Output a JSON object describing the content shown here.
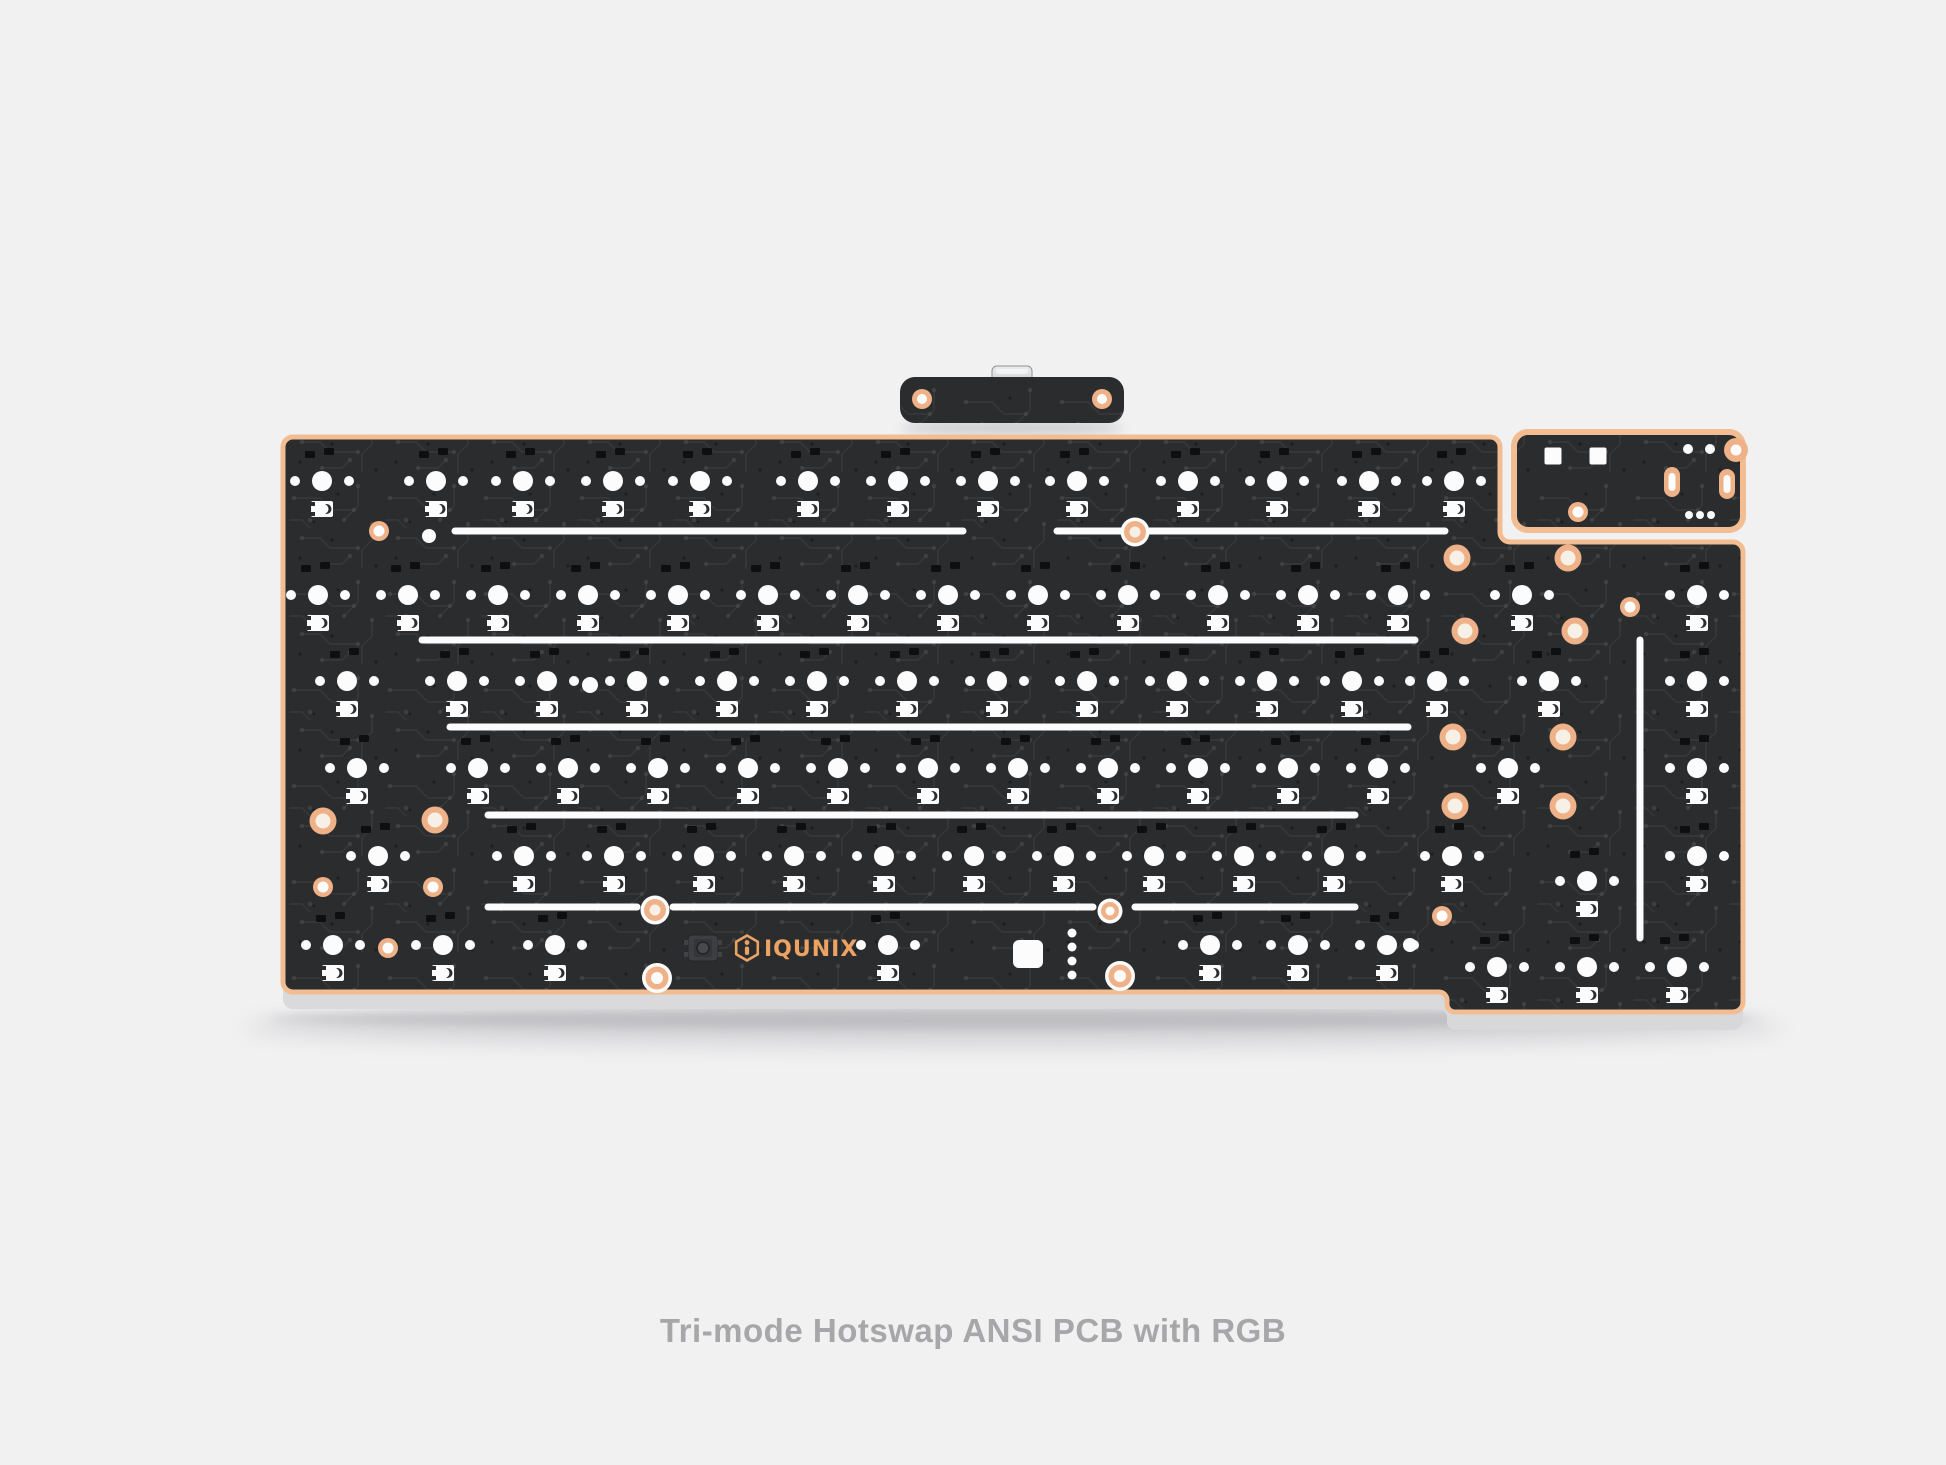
{
  "caption": {
    "text": "Tri-mode Hotswap ANSI PCB with RGB"
  },
  "logo": {
    "brand": "IQUNIX"
  },
  "palette": {
    "background": "#f1f1f2",
    "board": "#2b2c2d",
    "trace": "#45474a",
    "trace_dot": "#505255",
    "trace_dark": "#1b1c1d",
    "copper": "#f2bd92",
    "ring_copper": "#efb187",
    "cream": "#f7f0e6",
    "white": "#fcfcfd",
    "pad_dark": "#0e0f10",
    "logo_copper": "#eba263",
    "caption_gray": "#a7a7a9",
    "metal_light": "#eceded",
    "metal_dark": "#a7a9ac",
    "side_top": "#ffffff",
    "side_bottom": "#d8d8da",
    "shadow": "#73737a"
  },
  "board": {
    "left": 283,
    "top": 437,
    "right": 1743,
    "bottom_left": 992,
    "bottom_right": 1012,
    "notch_x": 1500,
    "notch_y": 542,
    "step_x": 1447,
    "corner_radius": 10
  },
  "usb_daughterboard": {
    "x": 900,
    "y": 377,
    "w": 224,
    "h": 46,
    "radius": 15,
    "screws": [
      [
        922,
        399
      ],
      [
        1102,
        399
      ]
    ],
    "connector": {
      "x": 992,
      "y": 366,
      "w": 40,
      "h": 38
    }
  },
  "corner_module": {
    "x": 1514,
    "y": 432,
    "w": 229,
    "h": 98,
    "radius": 14,
    "squares": [
      [
        1553,
        456
      ],
      [
        1598,
        456
      ]
    ],
    "square_size": 17,
    "ring": [
      1578,
      512
    ],
    "corner_circle": [
      1736,
      450
    ],
    "top_dots": [
      [
        1688,
        449
      ],
      [
        1710,
        449
      ]
    ],
    "ovals": [
      [
        1672,
        482
      ],
      [
        1727,
        484
      ]
    ],
    "bottom_dots": [
      [
        1689,
        515
      ],
      [
        1700,
        515
      ],
      [
        1711,
        515
      ]
    ]
  },
  "switch_rows": [
    {
      "y": 481,
      "xs": [
        322,
        436,
        523,
        613,
        700,
        808,
        898,
        988,
        1077,
        1188,
        1277,
        1369,
        1454
      ]
    },
    {
      "y": 595,
      "xs": [
        318,
        408,
        498,
        588,
        678,
        768,
        858,
        948,
        1038,
        1128,
        1218,
        1308,
        1398,
        1522,
        1697
      ]
    },
    {
      "y": 681,
      "xs": [
        347,
        457,
        547,
        637,
        727,
        817,
        907,
        997,
        1087,
        1177,
        1267,
        1352,
        1437,
        1549,
        1697
      ]
    },
    {
      "y": 768,
      "xs": [
        357,
        478,
        568,
        658,
        748,
        838,
        928,
        1018,
        1108,
        1198,
        1288,
        1378,
        1508,
        1697
      ]
    },
    {
      "y": 856,
      "xs": [
        378,
        524,
        614,
        704,
        794,
        884,
        974,
        1064,
        1154,
        1244,
        1334,
        1452,
        1697
      ]
    },
    {
      "y": 945,
      "xs": [
        333,
        443,
        555,
        888,
        1210,
        1298,
        1387
      ]
    }
  ],
  "extra_clusters": [
    [
      1587,
      881
    ],
    [
      1497,
      967
    ],
    [
      1587,
      967
    ],
    [
      1677,
      967
    ]
  ],
  "slot_lines": [
    [
      531,
      455,
      963
    ],
    [
      531,
      1057,
      1445
    ],
    [
      640,
      422,
      1415
    ],
    [
      727,
      450,
      1408
    ],
    [
      815,
      488,
      1355
    ],
    [
      907,
      488,
      637
    ],
    [
      907,
      673,
      1093
    ],
    [
      907,
      1135,
      1355
    ]
  ],
  "vertical_line": {
    "x": 1640,
    "y1": 640,
    "y2": 938
  },
  "screws_large": [
    [
      1135,
      532
    ],
    [
      655,
      910
    ]
  ],
  "screws_small": [
    [
      1110,
      911
    ]
  ],
  "rings_small": [
    [
      379,
      531
    ],
    [
      388,
      948
    ],
    [
      1442,
      916
    ],
    [
      323,
      887
    ],
    [
      433,
      887
    ],
    [
      1630,
      607
    ]
  ],
  "rings_big": [
    [
      323,
      821
    ],
    [
      435,
      820
    ],
    [
      1457,
      558
    ],
    [
      1568,
      558
    ],
    [
      1465,
      631
    ],
    [
      1575,
      631
    ],
    [
      1453,
      737
    ],
    [
      1563,
      737
    ],
    [
      1455,
      806
    ],
    [
      1563,
      806
    ]
  ],
  "edge_bumps": [
    [
      657,
      978
    ],
    [
      1120,
      976
    ]
  ],
  "white_dots": [
    [
      429,
      536,
      7
    ],
    [
      590,
      685,
      8
    ],
    [
      1410,
      945,
      7
    ]
  ],
  "white_square": {
    "x": 1028,
    "y": 954,
    "w": 30,
    "h": 28
  },
  "dot_column": {
    "x": 1072,
    "ys": [
      933,
      947,
      961,
      975
    ],
    "r": 4.5
  },
  "reset_switch": {
    "x": 703,
    "y": 948
  },
  "logo_pos": {
    "x": 747,
    "y": 948
  }
}
